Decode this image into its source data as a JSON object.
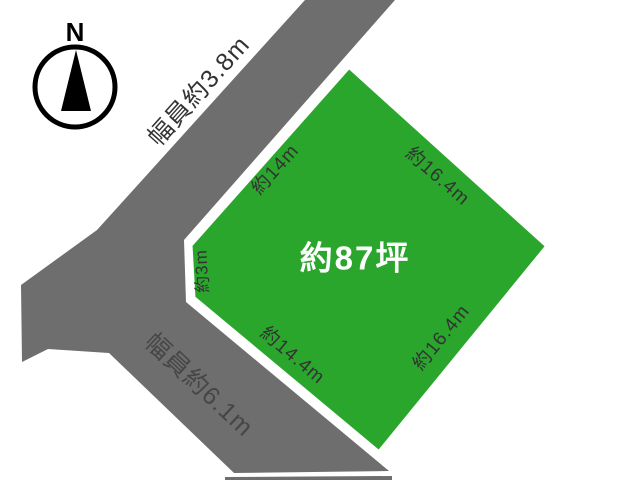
{
  "compass": {
    "north_label": "N"
  },
  "roads": {
    "north_road": {
      "width_label": "幅員約3.8m"
    },
    "south_road": {
      "width_label": "幅員約6.1m"
    }
  },
  "plot": {
    "area_label": "約87坪",
    "edge_labels": {
      "northwest": "約14m",
      "northeast": "約16.4m",
      "west": "約3m",
      "southwest": "約14.4m",
      "southeast": "約16.4m"
    }
  },
  "colors": {
    "plot_green": "#2aa62c",
    "road_gray": "#6e6e6e",
    "road_label_gray": "#464646",
    "edge_label_dark": "#333333",
    "area_label_white": "#ffffff",
    "compass_black": "#000000"
  }
}
